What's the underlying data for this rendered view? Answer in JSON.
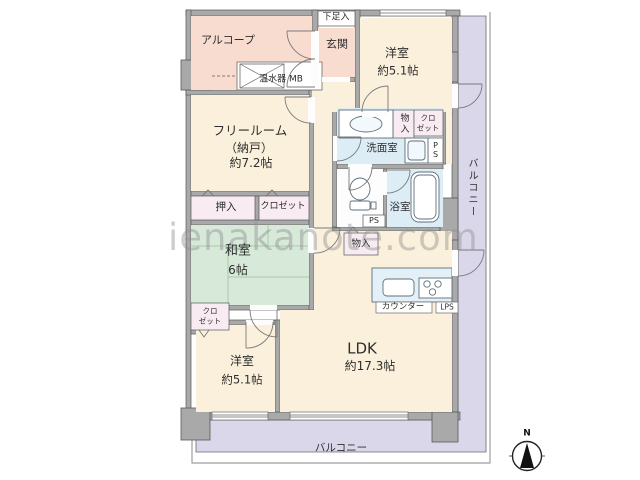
{
  "watermark": "ienakanote.com",
  "compass": {
    "north_label": "N"
  },
  "colors": {
    "room_cream": "#fbf0dc",
    "room_pink": "#f9dcd0",
    "room_green": "#d7eada",
    "room_wet_blue": "#ddedf6",
    "closet_pink": "#f8ecf2",
    "balcony_purple": "#dbd7ea",
    "wall_gray": "#a9a9a9"
  },
  "rooms": {
    "alcove": {
      "label": "アルコープ"
    },
    "shoe_cupboard": {
      "label": "下足入"
    },
    "entrance": {
      "label": "玄関"
    },
    "water_heater": {
      "label": "温水器 MB"
    },
    "western_room_top": {
      "label": "洋室",
      "size": "約5.1帖"
    },
    "balcony_right": {
      "label": "バルコニー"
    },
    "free_room": {
      "label": "フリールーム",
      "label2": "（納戸）",
      "size": "約7.2帖"
    },
    "oshiire": {
      "label": "押入"
    },
    "closet_center": {
      "label": "クロゼット"
    },
    "washroom": {
      "label": "洗面室"
    },
    "storage_upper": {
      "label": "物入"
    },
    "closet_upper": {
      "label": "クロ",
      "label2": "ゼット"
    },
    "pipe_space_upper": {
      "label": "PS"
    },
    "pipe_space_toilet": {
      "label": "PS"
    },
    "bathroom": {
      "label": "浴室"
    },
    "japanese_room": {
      "label": "和室",
      "size": "6帖"
    },
    "closet_left": {
      "label": "クロ",
      "label2": "ゼット"
    },
    "storage_kitchen": {
      "label": "物入"
    },
    "kitchen_counter": {
      "label": "カウンター"
    },
    "pipe_space_kitchen": {
      "label": "LPS"
    },
    "ldk": {
      "label": "LDK",
      "size": "約17.3帖"
    },
    "western_room_bottom": {
      "label": "洋室",
      "size": "約5.1帖"
    },
    "balcony_bottom": {
      "label": "バルコニー"
    }
  }
}
